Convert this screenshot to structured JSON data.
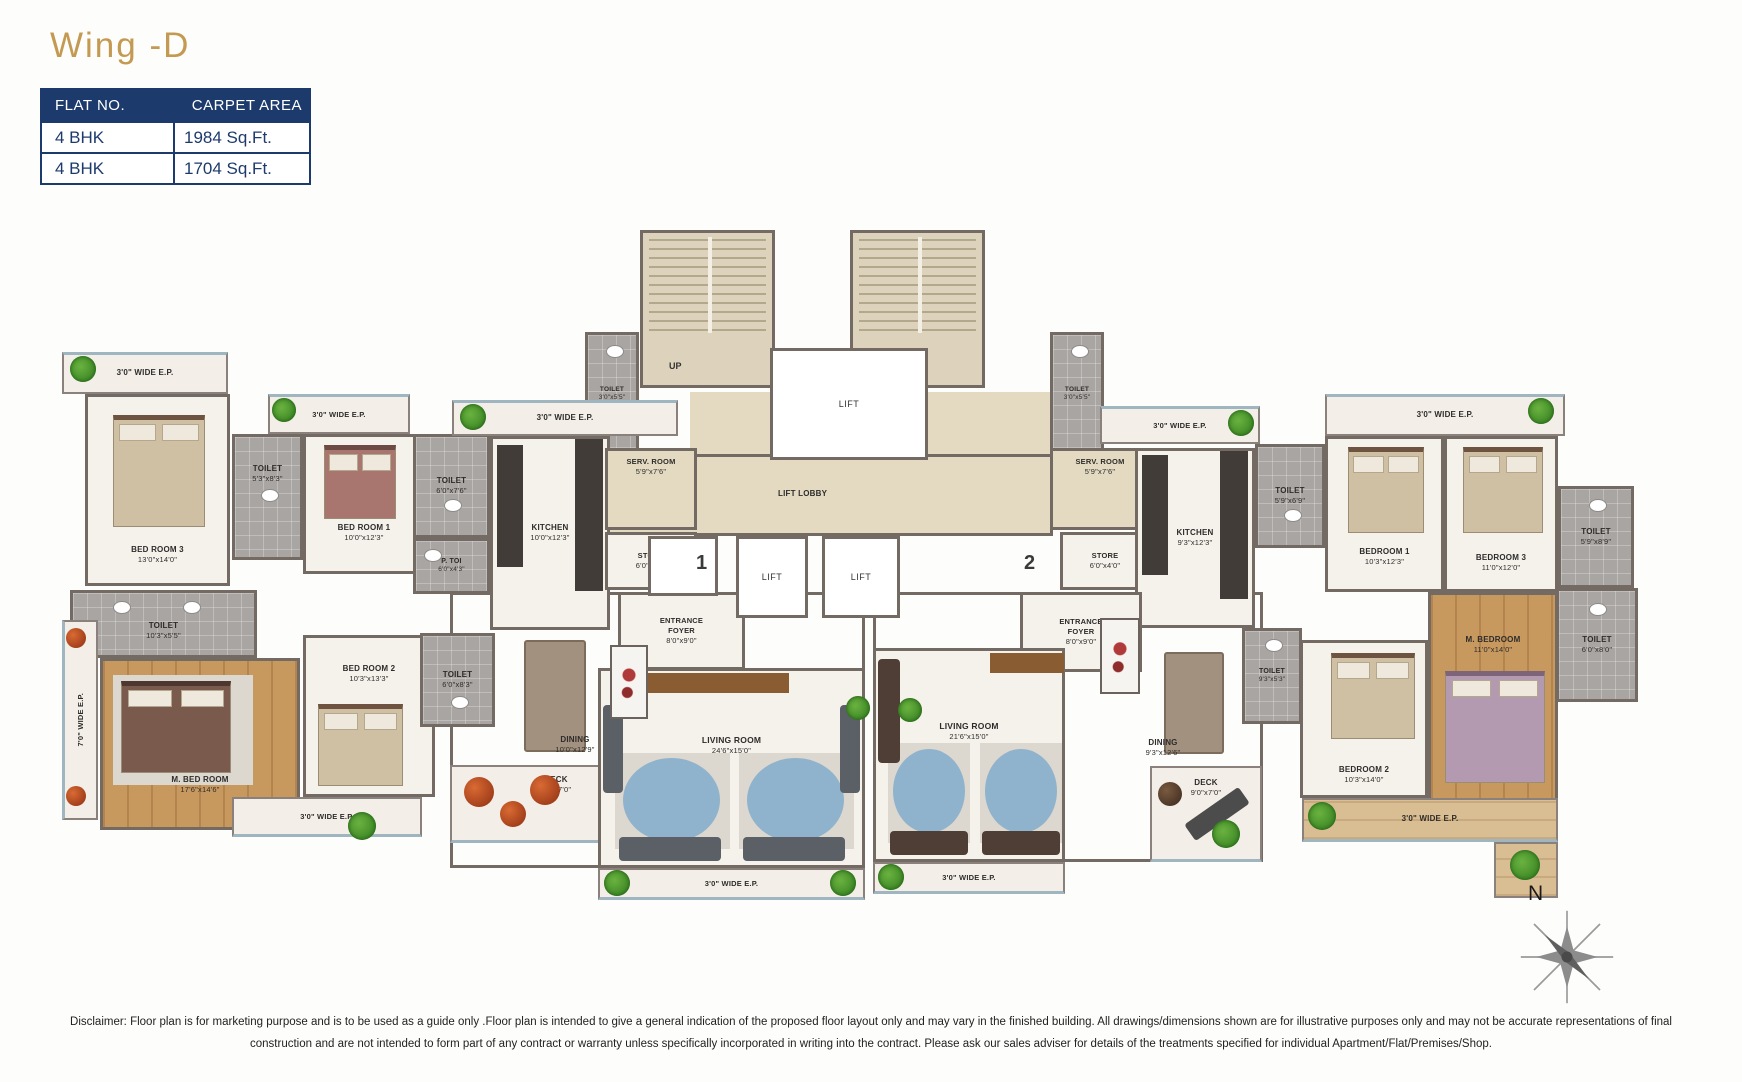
{
  "colors": {
    "brand_gold": "#C49A52",
    "table_navy": "#1D3A6D"
  },
  "header": {
    "title": "Wing -D"
  },
  "table": {
    "col1": "FLAT NO.",
    "col2": "CARPET AREA",
    "rows": [
      {
        "flat": "4 BHK",
        "area": "1984 Sq.Ft."
      },
      {
        "flat": "4 BHK",
        "area": "1704 Sq.Ft."
      }
    ]
  },
  "plan": {
    "left_flat": {
      "unit_number": "1",
      "ep_top": "3'0\" WIDE E.P.",
      "bedroom3": {
        "name": "BED ROOM 3",
        "dims": "13'0\"x14'0\""
      },
      "toilet_bed3": {
        "name": "TOILET",
        "dims": "5'3\"x8'3\""
      },
      "ep_bed1": "3'0\" WIDE E.P.",
      "bedroom1": {
        "name": "BED ROOM 1",
        "dims": "10'0\"x12'3\""
      },
      "toilet_bed1": {
        "name": "TOILET",
        "dims": "6'0\"x7'6\""
      },
      "powder_toilet": {
        "name": "P. TOI",
        "dims": "6'0\"x4'3\""
      },
      "kitchen": {
        "name": "KITCHEN",
        "dims": "10'0\"x12'3\""
      },
      "ep_kitchen": "3'0\" WIDE E.P.",
      "serv_room": {
        "name": "SERV. ROOM",
        "dims": "5'9\"x7'6\""
      },
      "toilet_common": {
        "name": "TOILET",
        "dims": "3'0\"x5'5\""
      },
      "store": {
        "name": "STORE",
        "dims": "6'0\"x4'0\""
      },
      "entrance_foyer": {
        "name": "ENTRANCE FOYER",
        "dims": "8'0\"x9'0\""
      },
      "toilet_master": {
        "name": "TOILET",
        "dims": "10'3\"x5'5\""
      },
      "master_bedroom": {
        "name": "M. BED ROOM",
        "dims": "17'6\"x14'6\""
      },
      "ep_side": "7'0\" WIDE E.P.",
      "bedroom2": {
        "name": "BED ROOM 2",
        "dims": "10'3\"x13'3\""
      },
      "ep_bed2": "3'0\" WIDE E.P.",
      "toilet_bed2": {
        "name": "TOILET",
        "dims": "6'0\"x8'3\""
      },
      "dining": {
        "name": "DINING",
        "dims": "10'0\"x12'9\""
      },
      "deck": {
        "name": "DECK",
        "dims": "9'9\"x7'0\""
      },
      "living": {
        "name": "LIVING ROOM",
        "dims": "24'6\"x15'0\""
      },
      "ep_bottom": "3'0\" WIDE E.P."
    },
    "core": {
      "up_left": "UP",
      "up_right": "UP",
      "lift_top": "LIFT",
      "lift_lobby": "LIFT LOBBY",
      "lift_a": "LIFT",
      "lift_b": "LIFT"
    },
    "right_flat": {
      "unit_number": "2",
      "toilet_common": {
        "name": "TOILET",
        "dims": "3'0\"x5'5\""
      },
      "serv_room": {
        "name": "SERV. ROOM",
        "dims": "5'9\"x7'6\""
      },
      "store": {
        "name": "STORE",
        "dims": "6'0\"x4'0\""
      },
      "ep_kitchen": "3'0\" WIDE E.P.",
      "kitchen": {
        "name": "KITCHEN",
        "dims": "9'3\"x12'3\""
      },
      "toilet_kitchen": {
        "name": "TOILET",
        "dims": "5'9\"x6'9\""
      },
      "ep_top": "3'0\" WIDE E.P.",
      "bedroom1": {
        "name": "BEDROOM 1",
        "dims": "10'3\"x12'3\""
      },
      "bedroom3": {
        "name": "BEDROOM 3",
        "dims": "11'0\"x12'0\""
      },
      "toilet_bed3": {
        "name": "TOILET",
        "dims": "5'9\"x8'9\""
      },
      "entrance_foyer": {
        "name": "ENTRANCE FOYER",
        "dims": "8'0\"x9'0\""
      },
      "toilet_dining": {
        "name": "TOILET",
        "dims": "9'3\"x5'3\""
      },
      "master_bedroom": {
        "name": "M. BEDROOM",
        "dims": "11'0\"x14'0\""
      },
      "toilet_master": {
        "name": "TOILET",
        "dims": "6'0\"x8'0\""
      },
      "bedroom2": {
        "name": "BEDROOM 2",
        "dims": "10'3\"x14'0\""
      },
      "living": {
        "name": "LIVING ROOM",
        "dims": "21'6\"x15'0\""
      },
      "dining": {
        "name": "DINING",
        "dims": "9'3\"x12'6\""
      },
      "deck": {
        "name": "DECK",
        "dims": "9'0\"x7'0\""
      },
      "ep_bottom": "3'0\" WIDE E.P.",
      "ep_bedroom2": "3'0\" WIDE E.P."
    },
    "compass": {
      "label": "N"
    }
  },
  "disclaimer": {
    "line1": "Disclaimer: Floor plan is for marketing purpose and is to be used as a guide only .Floor plan is intended to give a general indication of the proposed floor layout only and may vary in the finished building. All drawings/dimensions shown are for illustrative purposes only and may not be accurate representations of final",
    "line2": "construction and are not intended to form part of any contract or warranty unless specifically incorporated in writing into the contract. Please ask our sales adviser for details of the treatments specified for individual Apartment/Flat/Premises/Shop."
  }
}
